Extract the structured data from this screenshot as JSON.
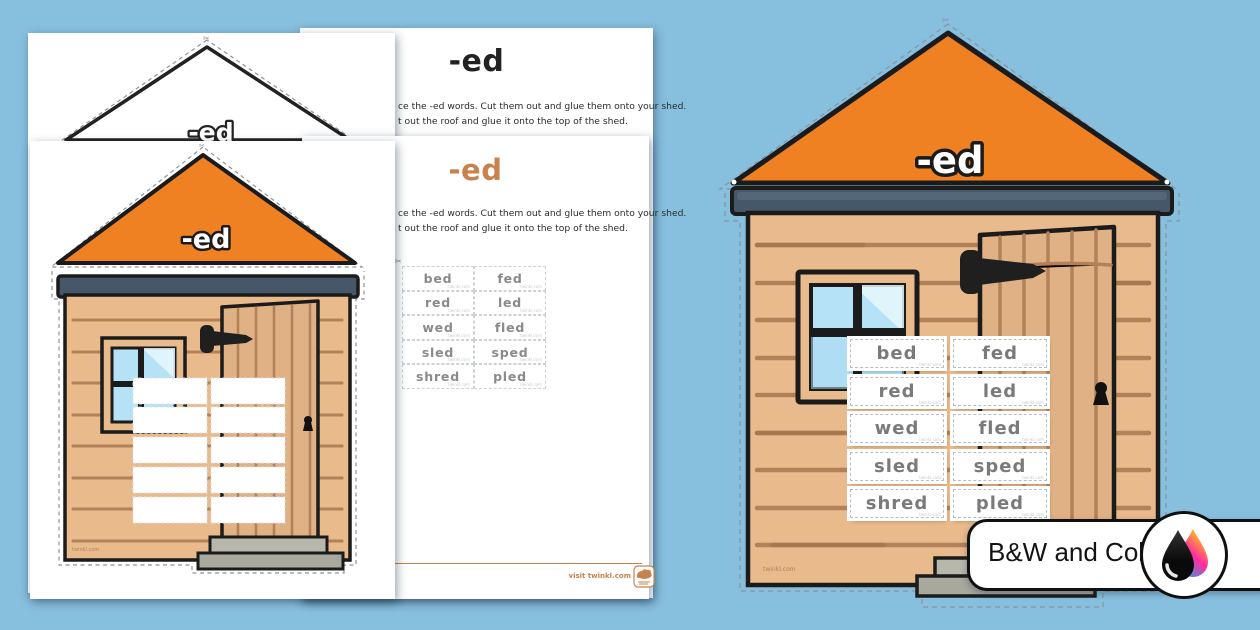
{
  "suffix_label": "-ed",
  "instructions": {
    "title": "-ed",
    "line1": "ce the -ed words. Cut them out and glue them onto your shed.",
    "line2": "t out the roof and glue it onto the top of the shed."
  },
  "word_pairs": [
    [
      "bed",
      "fed"
    ],
    [
      "red",
      "led"
    ],
    [
      "wed",
      "fled"
    ],
    [
      "sled",
      "sped"
    ],
    [
      "shred",
      "pled"
    ]
  ],
  "watermark": "twinkl.com",
  "footer": {
    "visit_label": "visit twinkl.com"
  },
  "badge": {
    "label": "B&W and Color"
  },
  "icons": {
    "scissors_mark": "✂"
  },
  "colors": {
    "background_blue": "#87bfdf",
    "roof_orange": "#ef8122",
    "beam_slate": "#455769",
    "wood_tan": "#e9ba8b",
    "accent_orange": "#c9824d"
  }
}
